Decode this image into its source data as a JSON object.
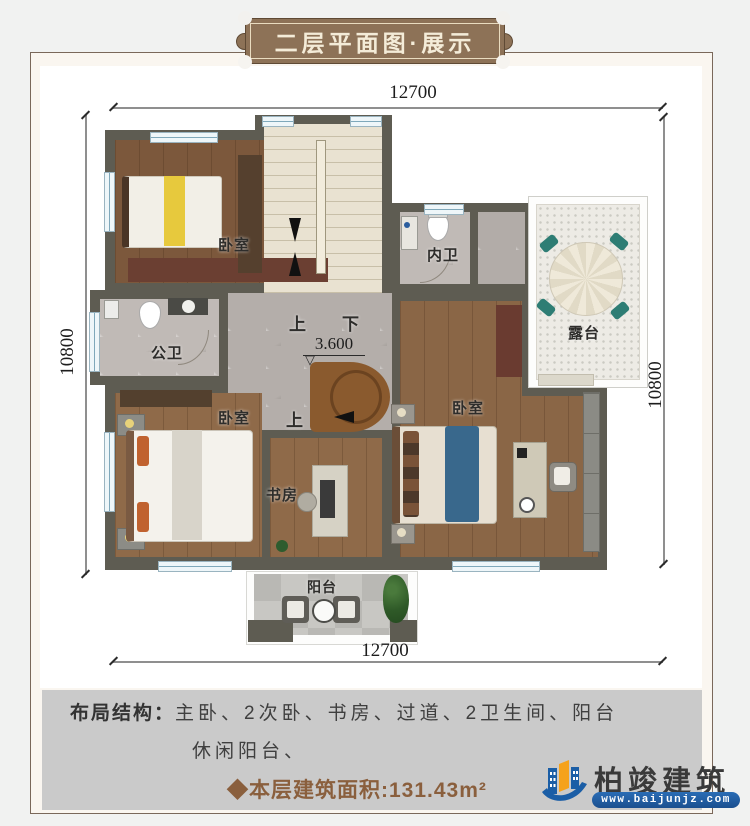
{
  "title_badge": {
    "text": "二层平面图·展示"
  },
  "dimensions": {
    "top": "12700",
    "bottom": "12700",
    "left": "10800",
    "right": "10800"
  },
  "plan": {
    "rooms": {
      "bedroom_top_left": "卧室",
      "bedroom_bottom_left": "卧室",
      "bedroom_master": "卧室",
      "inner_bath": "内卫",
      "public_bath": "公卫",
      "terrace": "露台",
      "study": "书房",
      "balcony": "阳台"
    },
    "stairs": {
      "up": "上",
      "down": "下",
      "up_spiral": "上",
      "elevation": "3.600",
      "elevation_mark": "▽"
    }
  },
  "footer": {
    "layout_label": "布局结构：",
    "layout_line1": "主卧、2次卧、书房、过道、2卫生间、阳台",
    "layout_line2": "休闲阳台、",
    "area_text": "◆本层建筑面积:131.43m²"
  },
  "logo": {
    "name": "柏竣建筑",
    "url": "www.baijunjz.com"
  },
  "colors": {
    "badge_brown": "#8d7257",
    "panel_gray": "#cacaca",
    "area_brown": "#8a5f3d",
    "wall": "#5e5c52",
    "logo_blue": "#1b5ea6",
    "logo_orange": "#f5a21c"
  }
}
